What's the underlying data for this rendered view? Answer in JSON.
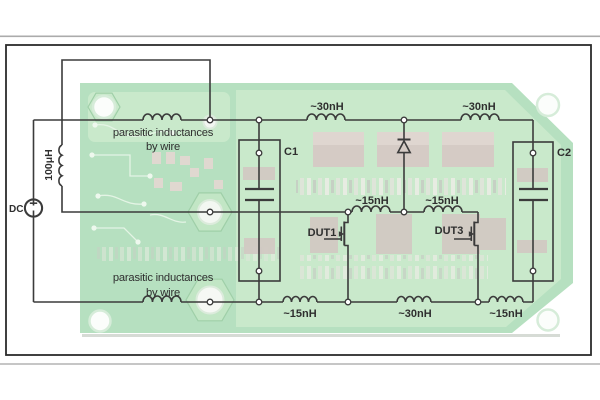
{
  "colors": {
    "page_bg": "#ffffff",
    "divider_top": "#ababab",
    "divider_bottom": "#c6c6c6",
    "frame_border": "#2b2b2b",
    "board_green": "#b6e0c0",
    "pour_green": "#c9e9cb",
    "pad_gray": "#d5cbc5",
    "hole_white": "#fbfdfb",
    "wire": "#3b3b3b",
    "text": "#2f2f2f"
  },
  "labels": {
    "dc_source": "DC",
    "load_inductor": "100μH",
    "cap1": "C1",
    "cap2": "C2",
    "dut1": "DUT1",
    "dut3": "DUT3",
    "top_inductor_1": "~30nH",
    "top_inductor_2": "~30nH",
    "mid_inductor_1": "~15nH",
    "mid_inductor_2": "~15nH",
    "bottom_inductor_1": "~15nH",
    "bottom_inductor_2": "~30nH",
    "bottom_inductor_3": "~15nH",
    "note_top_line1": "parasitic inductances",
    "note_top_line2": "by wire",
    "note_bottom_line1": "parasitic inductances",
    "note_bottom_line2": "by wire"
  }
}
